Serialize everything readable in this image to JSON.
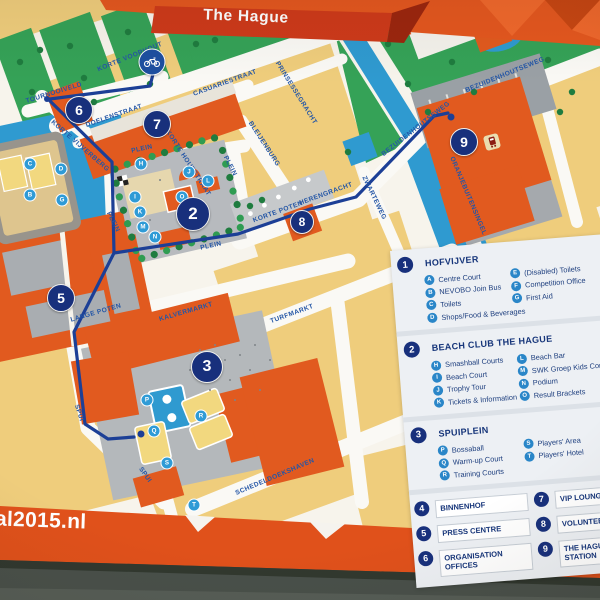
{
  "sign": {
    "title": "The Hague",
    "url_text": "al2015.nl",
    "colors": {
      "band_orange": "#e4571f",
      "ribbon_red": "#ce3a1a",
      "route_blue": "#1c3f96",
      "marker_navy": "#18307c",
      "letter_blue": "#2f9bd6",
      "water": "#2f9ad0",
      "park_green": "#35a257",
      "building_yellow": "#efcd7c",
      "building_orange": "#e15a1f",
      "plaza_gray": "#b7babe",
      "street_text_blue": "#2456a6",
      "legend_text": "#1d3e7e"
    }
  },
  "map": {
    "street_labels": [
      {
        "text": "KORTE VOORHOUT",
        "x": 130,
        "y": 57,
        "rot": -22
      },
      {
        "text": "TOURNOOIVELD",
        "x": 54,
        "y": 93,
        "rot": -17
      },
      {
        "text": "DOELENSTRAAT",
        "x": 114,
        "y": 116,
        "rot": -19
      },
      {
        "text": "CASUARIESTRAAT",
        "x": 225,
        "y": 83,
        "rot": -20
      },
      {
        "text": "PRINSESSEGRACHT",
        "x": 296,
        "y": 93,
        "rot": 58
      },
      {
        "text": "BLEIJENBURG",
        "x": 264,
        "y": 144,
        "rot": 57
      },
      {
        "text": "KORTE VIJVERBERG",
        "x": 80,
        "y": 146,
        "rot": 41
      },
      {
        "text": "KORTE HOUTSTRAAT",
        "x": 188,
        "y": 163,
        "rot": 57
      },
      {
        "text": "PLEIN",
        "x": 142,
        "y": 149,
        "rot": -12
      },
      {
        "text": "PLEIN",
        "x": 230,
        "y": 166,
        "rot": 63
      },
      {
        "text": "PLEIN",
        "x": 211,
        "y": 246,
        "rot": -12
      },
      {
        "text": "PLEIN",
        "x": 113,
        "y": 222,
        "rot": 63
      },
      {
        "text": "KORTE POTEN",
        "x": 278,
        "y": 212,
        "rot": -20
      },
      {
        "text": "HERENGRACHT",
        "x": 326,
        "y": 194,
        "rot": -20
      },
      {
        "text": "ZWARTEWEG",
        "x": 374,
        "y": 198,
        "rot": 64
      },
      {
        "text": "BEZUIDENHOUTSEWEG",
        "x": 505,
        "y": 75,
        "rot": -22
      },
      {
        "text": "BEZUIDENHOUTSEWEG",
        "x": 416,
        "y": 129,
        "rot": -38
      },
      {
        "text": "ORANJEBUITENSINGEL",
        "x": 468,
        "y": 196,
        "rot": 67
      },
      {
        "text": "LANGE POTEN",
        "x": 96,
        "y": 313,
        "rot": -16
      },
      {
        "text": "KALVERMARKT",
        "x": 186,
        "y": 312,
        "rot": -16
      },
      {
        "text": "TURFMARKT",
        "x": 292,
        "y": 314,
        "rot": -20
      },
      {
        "text": "SPUI",
        "x": 79,
        "y": 413,
        "rot": 72
      },
      {
        "text": "SPUI",
        "x": 145,
        "y": 475,
        "rot": 55
      },
      {
        "text": "SCHEDELDOEKSHAVEN",
        "x": 275,
        "y": 477,
        "rot": -23
      }
    ],
    "number_markers": [
      {
        "num": "2",
        "x": 193,
        "y": 214,
        "r": 16
      },
      {
        "num": "3",
        "x": 207,
        "y": 367,
        "r": 15
      },
      {
        "num": "5",
        "x": 61,
        "y": 298,
        "r": 13
      },
      {
        "num": "6",
        "x": 79,
        "y": 110,
        "r": 13
      },
      {
        "num": "7",
        "x": 157,
        "y": 124,
        "r": 13
      },
      {
        "num": "8",
        "x": 302,
        "y": 222,
        "r": 11
      },
      {
        "num": "9",
        "x": 464,
        "y": 142,
        "r": 13
      }
    ],
    "letter_markers": [
      {
        "letter": "C",
        "x": 30,
        "y": 164
      },
      {
        "letter": "D",
        "x": 61,
        "y": 169
      },
      {
        "letter": "B",
        "x": 30,
        "y": 195
      },
      {
        "letter": "G",
        "x": 62,
        "y": 200
      },
      {
        "letter": "H",
        "x": 141,
        "y": 164
      },
      {
        "letter": "J",
        "x": 189,
        "y": 172
      },
      {
        "letter": "L",
        "x": 208,
        "y": 181
      },
      {
        "letter": "I",
        "x": 135,
        "y": 197
      },
      {
        "letter": "O",
        "x": 182,
        "y": 197
      },
      {
        "letter": "K",
        "x": 140,
        "y": 212
      },
      {
        "letter": "M",
        "x": 143,
        "y": 227
      },
      {
        "letter": "N",
        "x": 155,
        "y": 237
      },
      {
        "letter": "P",
        "x": 147,
        "y": 400
      },
      {
        "letter": "Q",
        "x": 154,
        "y": 431
      },
      {
        "letter": "R",
        "x": 201,
        "y": 416
      },
      {
        "letter": "S",
        "x": 167,
        "y": 463
      },
      {
        "letter": "T",
        "x": 194,
        "y": 505
      }
    ],
    "icons": [
      {
        "name": "bicycle-parking"
      },
      {
        "name": "train-station"
      }
    ]
  },
  "legend": {
    "sections": [
      {
        "num": "1",
        "title": "HOFVIJVER",
        "col1": [
          {
            "letter": "A",
            "label": "Centre Court"
          },
          {
            "letter": "B",
            "label": "NEVOBO Join Bus"
          },
          {
            "letter": "C",
            "label": "Toilets"
          },
          {
            "letter": "D",
            "label": "Shops/Food & Beverages"
          }
        ],
        "col2": [
          {
            "letter": "E",
            "label": "(Disabled) Toilets"
          },
          {
            "letter": "F",
            "label": "Competition Office"
          },
          {
            "letter": "G",
            "label": "First Aid"
          }
        ]
      },
      {
        "num": "2",
        "title": "BEACH CLUB THE HAGUE",
        "col1": [
          {
            "letter": "H",
            "label": "Smashball Courts"
          },
          {
            "letter": "I",
            "label": "Beach Court"
          },
          {
            "letter": "J",
            "label": "Trophy Tour"
          },
          {
            "letter": "K",
            "label": "Tickets & Information"
          }
        ],
        "col2": [
          {
            "letter": "L",
            "label": "Beach Bar"
          },
          {
            "letter": "M",
            "label": "SWK Groep Kids Corner"
          },
          {
            "letter": "N",
            "label": "Podium"
          },
          {
            "letter": "O",
            "label": "Result Brackets"
          }
        ]
      },
      {
        "num": "3",
        "title": "SPUIPLEIN",
        "col1": [
          {
            "letter": "P",
            "label": "Bossaball"
          },
          {
            "letter": "Q",
            "label": "Warm-up Court"
          },
          {
            "letter": "R",
            "label": "Training Courts"
          }
        ],
        "col2": [
          {
            "letter": "S",
            "label": "Players' Area"
          },
          {
            "letter": "T",
            "label": "Players' Hotel"
          }
        ]
      }
    ],
    "places": [
      {
        "num": "4",
        "label": "BINNENHOF"
      },
      {
        "num": "5",
        "label": "PRESS CENTRE"
      },
      {
        "num": "6",
        "label": "ORGANISATION OFFICES"
      },
      {
        "num": "7",
        "label": "VIP LOUNGE"
      },
      {
        "num": "8",
        "label": "VOLUNTEER HOME"
      },
      {
        "num": "9",
        "label": "THE HAGUE CENTRAL STATION"
      }
    ]
  }
}
